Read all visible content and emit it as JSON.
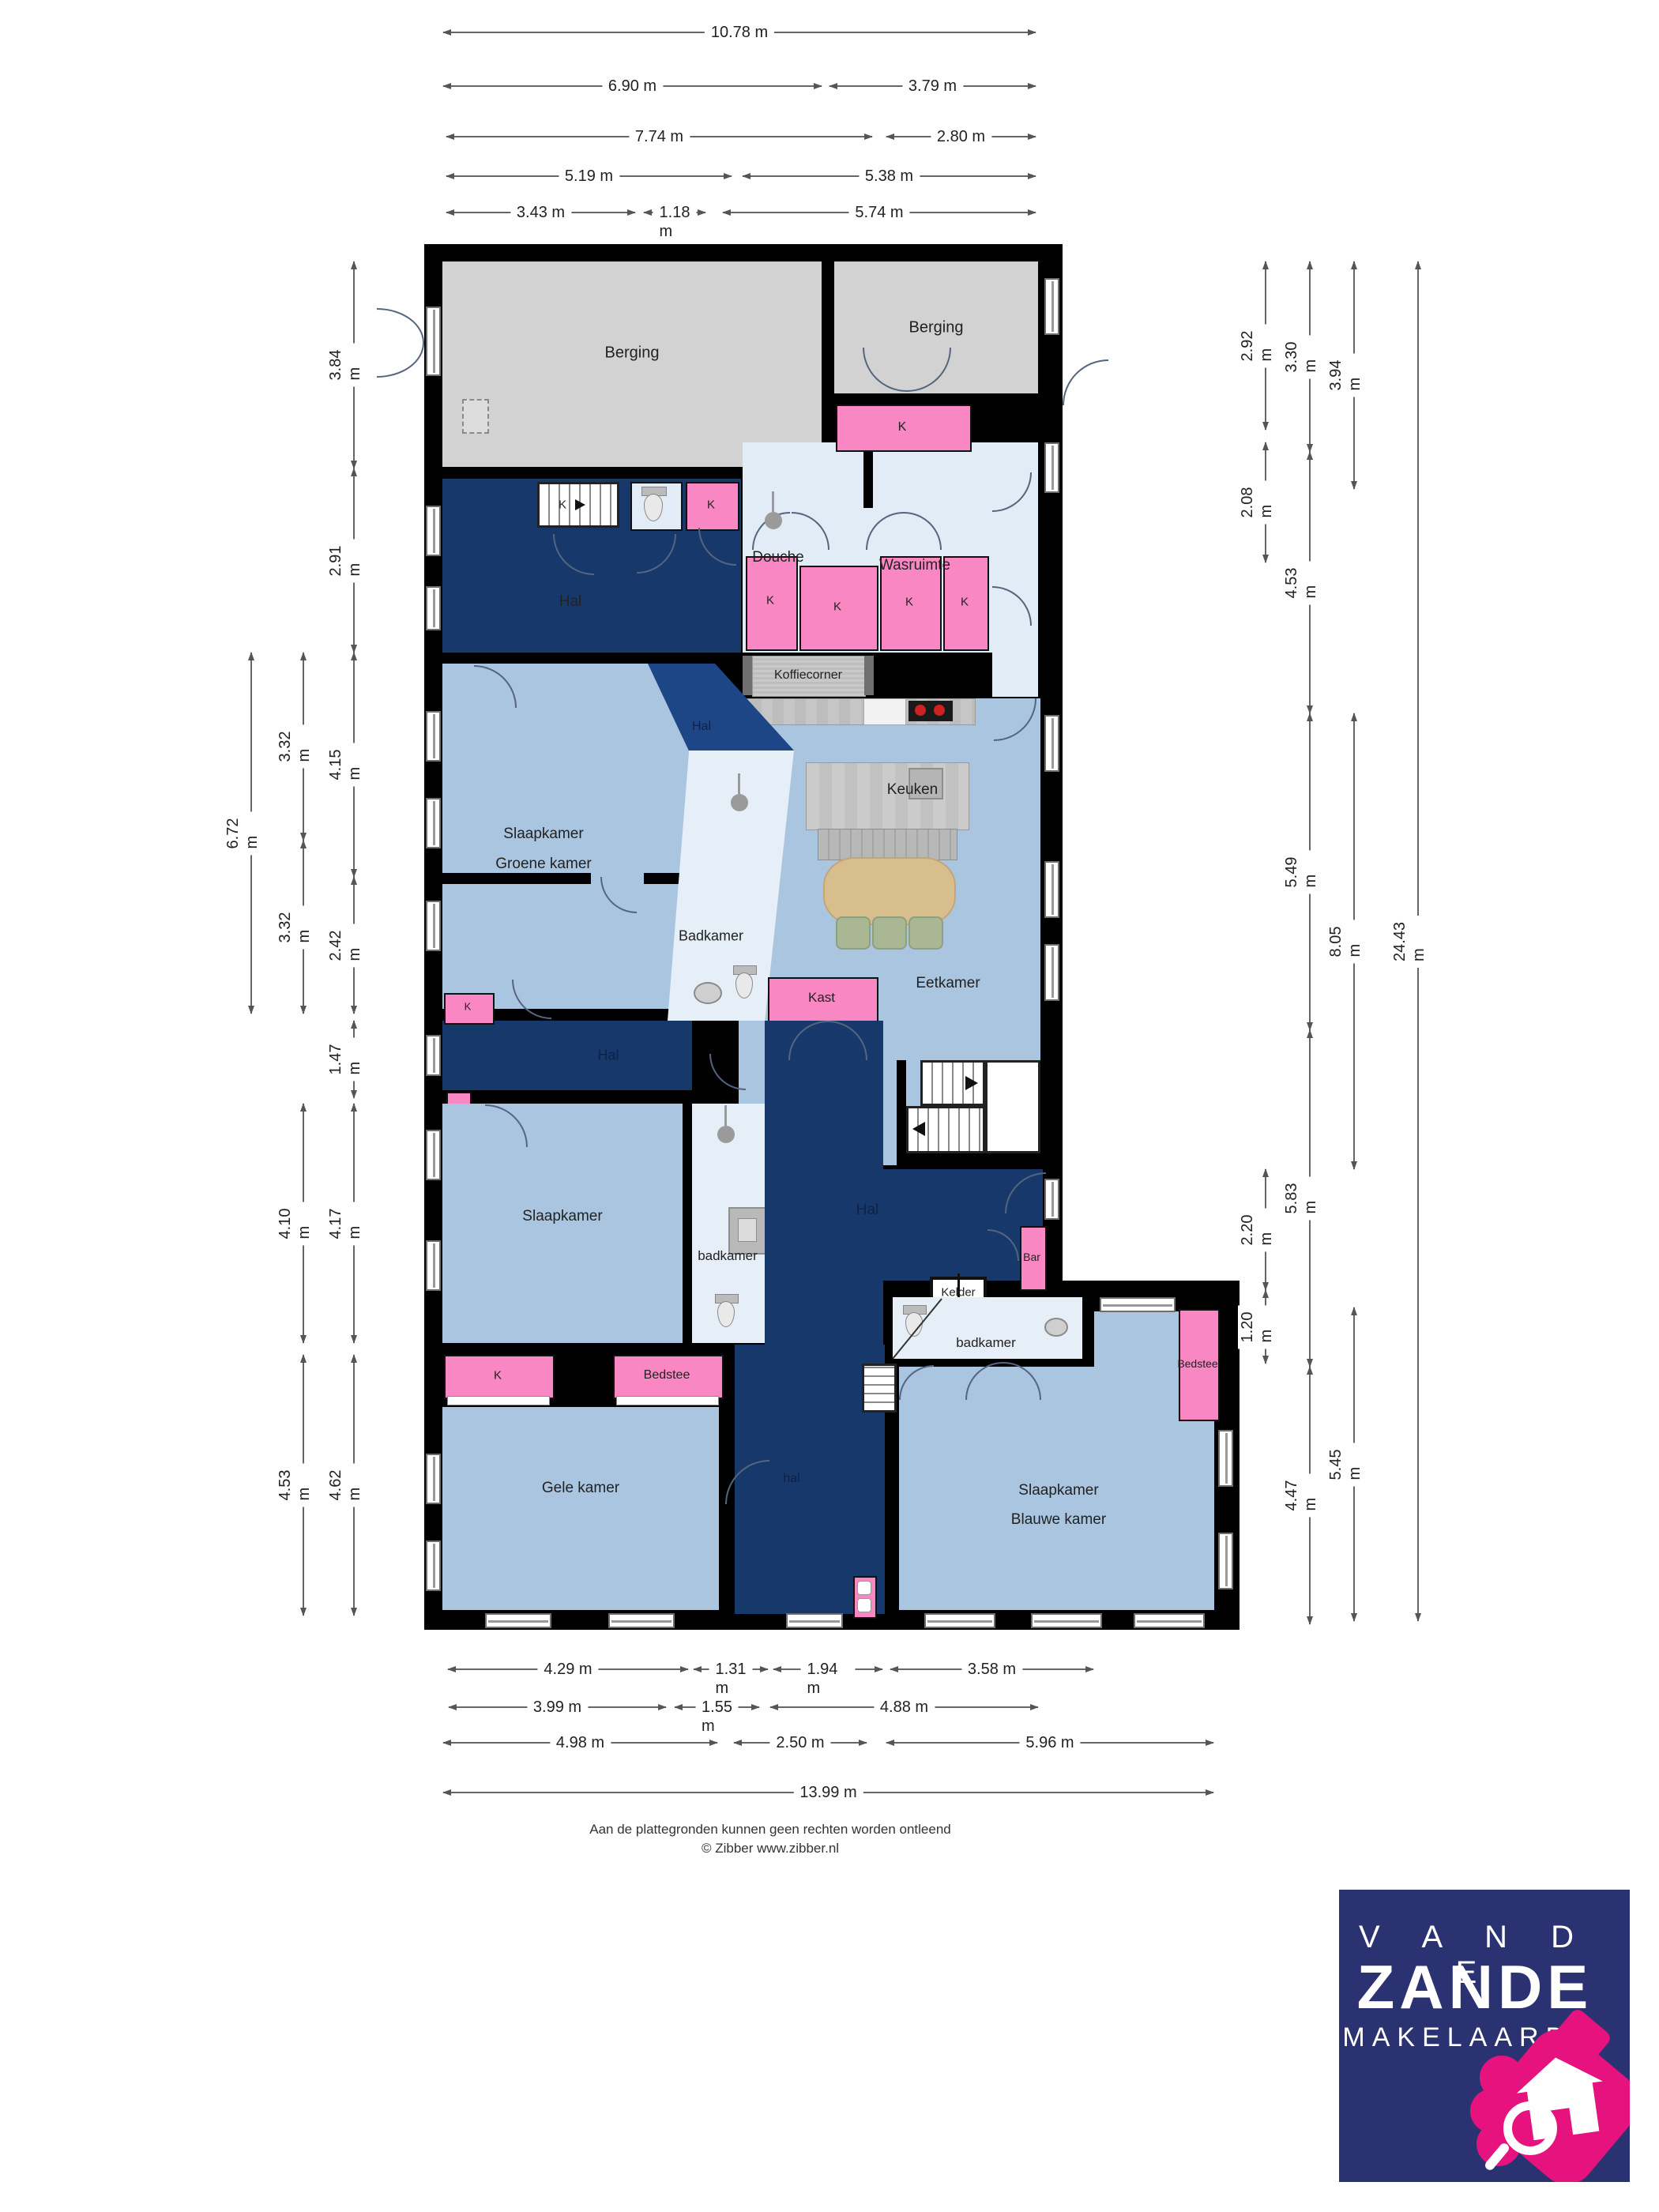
{
  "rooms": {
    "berging": "Berging",
    "hal": "Hal",
    "hal_small": "hal",
    "douche": "Douche",
    "wasruimte": "Wasruimte",
    "koffiecorner": "Koffiecorner",
    "keuken": "Keuken",
    "eetkamer": "Eetkamer",
    "slaapkamer": "Slaapkamer",
    "groene_kamer": "Groene kamer",
    "blauwe_kamer": "Blauwe kamer",
    "gele_kamer": "Gele kamer",
    "badkamer": "Badkamer",
    "badkamer_lc": "badkamer",
    "kast": "Kast",
    "bedstee": "Bedstee",
    "bar": "Bar",
    "kelder": "Kelder",
    "k": "K"
  },
  "dims": {
    "top": [
      "10.78 m",
      "6.90 m",
      "3.79 m",
      "7.74 m",
      "2.80 m",
      "5.19 m",
      "5.38 m",
      "3.43 m",
      "1.18 m",
      "5.74 m"
    ],
    "left": [
      "3.84 m",
      "2.91 m",
      "4.15 m",
      "2.42 m",
      "1.47 m",
      "4.17 m",
      "4.62 m",
      "3.32 m",
      "3.32 m",
      "4.10 m",
      "4.53 m",
      "6.72 m"
    ],
    "right": [
      "2.92 m",
      "2.08 m",
      "2.20 m",
      "1.20 m",
      "3.30 m",
      "4.53 m",
      "5.49 m",
      "5.83 m",
      "4.47 m",
      "3.94 m",
      "8.05 m",
      "5.45 m",
      "24.43 m"
    ],
    "bottom": [
      "4.29 m",
      "1.31 m",
      "1.94 m",
      "3.58 m",
      "3.99 m",
      "1.55 m",
      "4.88 m",
      "4.98 m",
      "2.50 m",
      "5.96 m",
      "13.99 m"
    ]
  },
  "footer": {
    "line1": "Aan de plattegronden kunnen geen rechten worden ontleend",
    "line2": "© Zibber www.zibber.nl"
  },
  "logo": {
    "line1": "V A N  D E",
    "line2": "ZANDE",
    "line3": "MAKELAARDIJ"
  },
  "colors": {
    "wall": "#000000",
    "room_blue": "#a9c5e0",
    "wet_room": "#e2ecf6",
    "hall_navy": "#16386b",
    "hall_navy_light": "#1d4687",
    "closet_pink": "#f987c3",
    "berging_gray": "#d2d2d2",
    "logo_navy": "#2b3272",
    "logo_pink": "#e6137e"
  }
}
